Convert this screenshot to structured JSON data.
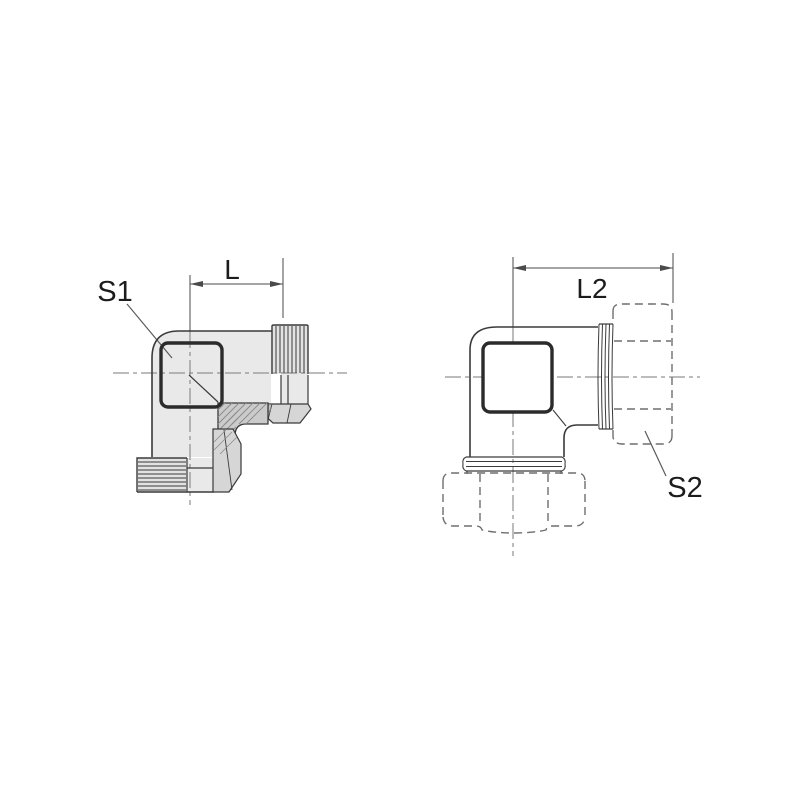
{
  "figure": {
    "background_color": "#ffffff",
    "line_color": "#3a3a3a",
    "body_fill": "#e9e9e9",
    "section_fill": "#cbcbcb",
    "phantom_line_color": "#6e6e6e",
    "labels": {
      "s1": "S1",
      "dim_l": "L",
      "dim_l2": "L2",
      "s2": "S2"
    }
  }
}
